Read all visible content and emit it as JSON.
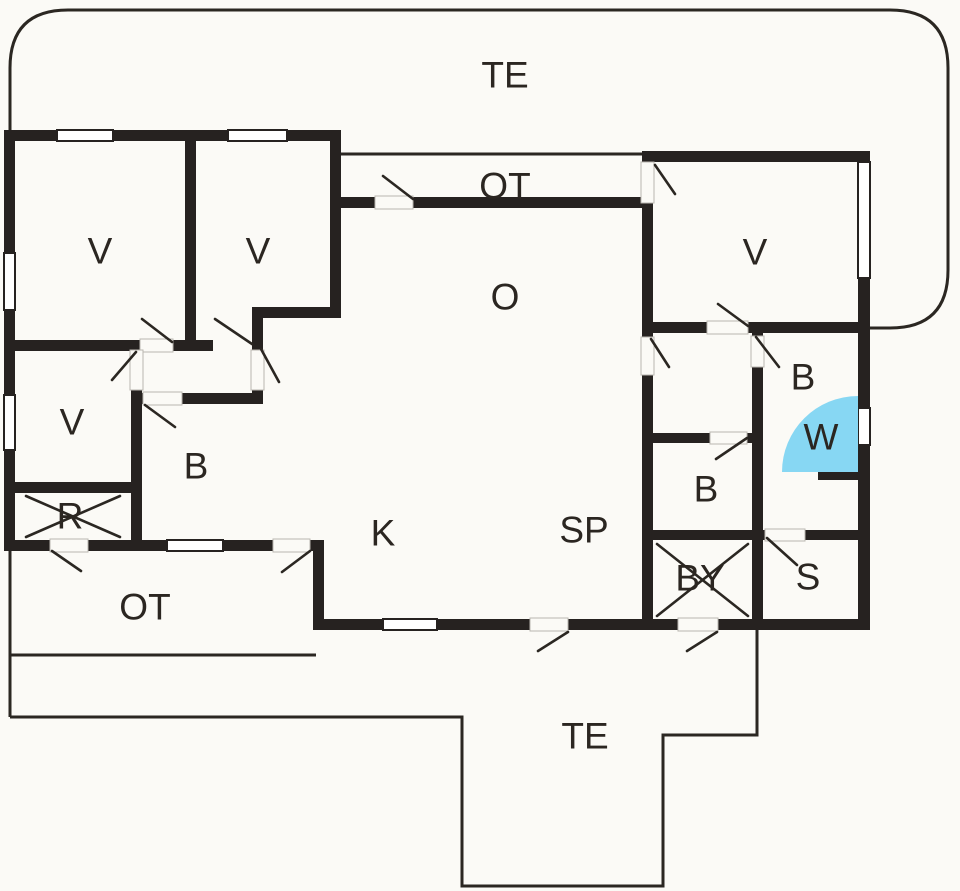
{
  "meta": {
    "type": "architectural-floor-plan",
    "description": "Holiday house floor plan with terraces"
  },
  "canvas": {
    "width": 960,
    "height": 891
  },
  "colors": {
    "background": "#fbfaf6",
    "wall": "#262220",
    "thin_line": "#2b2722",
    "swing_line": "#2b2722",
    "gap_stroke": "#bab7b0",
    "window_fill": "#ffffff",
    "shower_fill": "#87d7f3",
    "label": "#2b2621"
  },
  "labels": [
    {
      "id": "terrace-top",
      "text": "TE",
      "x": 505,
      "y": 75
    },
    {
      "id": "covered-terrace-top",
      "text": "OT",
      "x": 505,
      "y": 186
    },
    {
      "id": "bedroom-1",
      "text": "V",
      "x": 100,
      "y": 251
    },
    {
      "id": "bedroom-2",
      "text": "V",
      "x": 258,
      "y": 251
    },
    {
      "id": "bedroom-right",
      "text": "V",
      "x": 755,
      "y": 252
    },
    {
      "id": "living-room",
      "text": "O",
      "x": 505,
      "y": 297
    },
    {
      "id": "bedroom-left",
      "text": "V",
      "x": 72,
      "y": 422
    },
    {
      "id": "bath-left",
      "text": "B",
      "x": 196,
      "y": 466
    },
    {
      "id": "room-r-crossed",
      "text": "R",
      "x": 70,
      "y": 516
    },
    {
      "id": "bath-right",
      "text": "B",
      "x": 803,
      "y": 377
    },
    {
      "id": "shower-wc",
      "text": "W",
      "x": 821,
      "y": 437
    },
    {
      "id": "bath-center",
      "text": "B",
      "x": 706,
      "y": 489
    },
    {
      "id": "kitchen",
      "text": "K",
      "x": 383,
      "y": 533
    },
    {
      "id": "dining",
      "text": "SP",
      "x": 584,
      "y": 530
    },
    {
      "id": "room-by-crossed",
      "text": "BY",
      "x": 700,
      "y": 578
    },
    {
      "id": "sauna",
      "text": "S",
      "x": 808,
      "y": 577
    },
    {
      "id": "covered-porch",
      "text": "OT",
      "x": 145,
      "y": 607
    },
    {
      "id": "terrace-bottom",
      "text": "TE",
      "x": 585,
      "y": 736
    }
  ],
  "walls": [
    [
      4,
      130,
      11,
      421
    ],
    [
      4,
      130,
      337,
      11
    ],
    [
      330,
      130,
      11,
      183
    ],
    [
      255,
      307,
      86,
      11
    ],
    [
      185,
      141,
      11,
      210
    ],
    [
      4,
      340,
      136,
      11
    ],
    [
      173,
      340,
      40,
      11
    ],
    [
      131,
      340,
      11,
      11
    ],
    [
      131,
      390,
      11,
      161
    ],
    [
      131,
      393,
      131,
      11
    ],
    [
      252,
      307,
      11,
      43
    ],
    [
      252,
      390,
      11,
      14
    ],
    [
      4,
      482,
      138,
      11
    ],
    [
      4,
      540,
      320,
      11
    ],
    [
      313,
      540,
      11,
      90
    ],
    [
      313,
      619,
      557,
      11
    ],
    [
      334,
      197,
      319,
      11
    ],
    [
      642,
      151,
      11,
      479
    ],
    [
      642,
      151,
      228,
      11
    ],
    [
      642,
      322,
      228,
      11
    ],
    [
      752,
      333,
      11,
      286
    ],
    [
      648,
      433,
      115,
      10
    ],
    [
      648,
      530,
      115,
      10
    ],
    [
      752,
      530,
      118,
      10
    ],
    [
      818,
      470,
      40,
      10
    ],
    [
      858,
      151,
      12,
      479
    ]
  ],
  "windows": [
    [
      57,
      130,
      56,
      11
    ],
    [
      228,
      130,
      59,
      11
    ],
    [
      4,
      253,
      11,
      57
    ],
    [
      4,
      395,
      11,
      55
    ],
    [
      167,
      540,
      56,
      11
    ],
    [
      383,
      619,
      54,
      11
    ],
    [
      858,
      162,
      12,
      116
    ],
    [
      858,
      408,
      12,
      37
    ]
  ],
  "door_gaps": [
    [
      375,
      196,
      38,
      13
    ],
    [
      641,
      162,
      13,
      41
    ],
    [
      707,
      321,
      41,
      13
    ],
    [
      641,
      337,
      13,
      38
    ],
    [
      751,
      336,
      13,
      31
    ],
    [
      710,
      432,
      37,
      12
    ],
    [
      765,
      529,
      40,
      12
    ],
    [
      678,
      618,
      40,
      13
    ],
    [
      530,
      618,
      38,
      13
    ],
    [
      140,
      339,
      33,
      13
    ],
    [
      130,
      350,
      13,
      40
    ],
    [
      251,
      350,
      13,
      40
    ],
    [
      143,
      392,
      39,
      13
    ],
    [
      50,
      539,
      38,
      13
    ],
    [
      273,
      539,
      37,
      13
    ]
  ],
  "door_swings": [
    [
      413,
      199,
      383,
      176
    ],
    [
      655,
      165,
      675,
      194
    ],
    [
      748,
      326,
      718,
      304
    ],
    [
      651,
      339,
      669,
      367
    ],
    [
      756,
      337,
      779,
      367
    ],
    [
      747,
      438,
      716,
      459
    ],
    [
      767,
      538,
      797,
      565
    ],
    [
      717,
      632,
      687,
      651
    ],
    [
      568,
      632,
      538,
      651
    ],
    [
      172,
      342,
      142,
      319
    ],
    [
      215,
      319,
      252,
      344
    ],
    [
      136,
      352,
      112,
      380
    ],
    [
      261,
      349,
      279,
      382
    ],
    [
      145,
      405,
      175,
      427
    ],
    [
      52,
      551,
      81,
      571
    ],
    [
      310,
      551,
      282,
      572
    ]
  ],
  "outlines": [
    {
      "id": "terrace-top-outline",
      "d": "M 10 130 L 10 68 Q 10 10 68 10 L 890 10 Q 948 10 948 68 L 948 270 Q 948 328 890 328 L 864 328"
    },
    {
      "id": "balcony-edge-outline",
      "d": "M 341 154 L 647 154"
    },
    {
      "id": "terrace-bottom-outline",
      "d": "M 10 551 L 10 717 M 10 655 L 316 655 M 10 717 L 462 717 L 462 886 L 663 886 L 663 735 L 757 735 L 757 630"
    }
  ],
  "shower": {
    "d": "M 782 472 A 76 76 0 0 1 858 396 L 858 472 Z"
  },
  "crosses": [
    {
      "id": "cross-room-r",
      "lines": [
        [
          26,
          496,
          120,
          537
        ],
        [
          26,
          537,
          120,
          496
        ]
      ]
    },
    {
      "id": "cross-room-by",
      "lines": [
        [
          657,
          544,
          748,
          616
        ],
        [
          657,
          616,
          748,
          544
        ]
      ]
    }
  ]
}
